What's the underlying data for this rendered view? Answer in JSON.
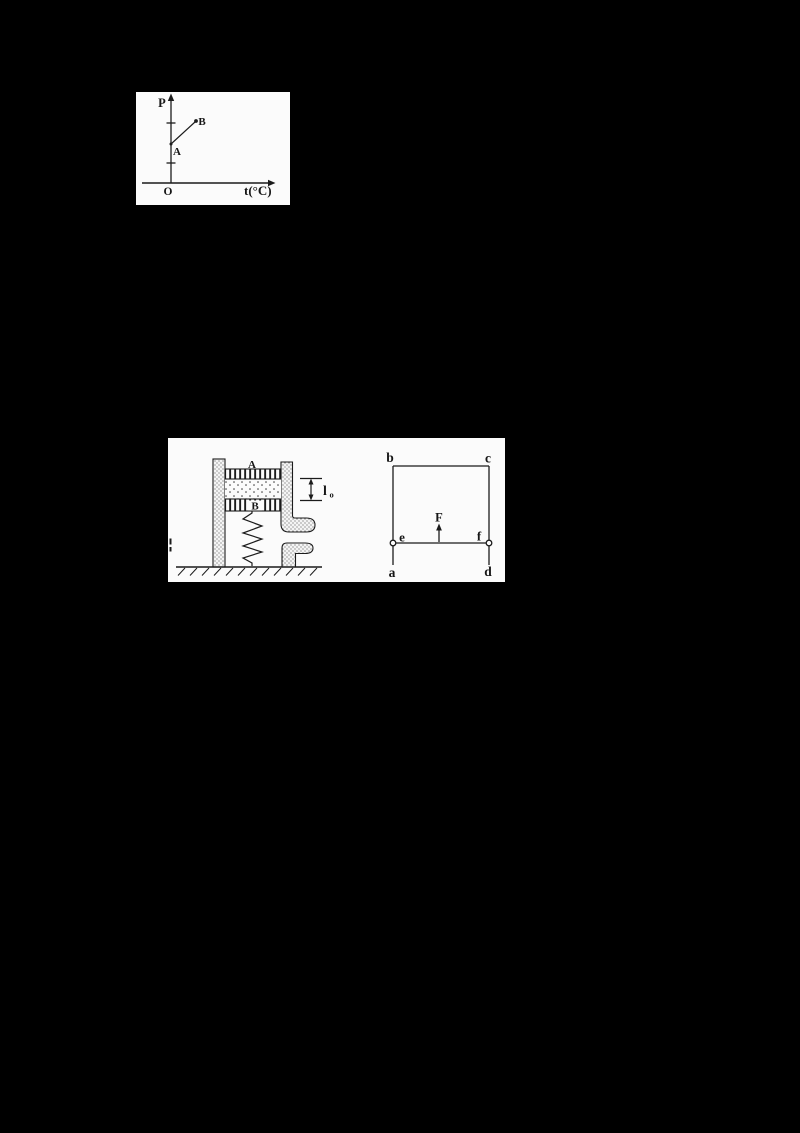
{
  "colors": {
    "page_bg": "#000000",
    "figure_bg": "#fbfbfb",
    "ink": "#1b1b1b"
  },
  "chart_data": {
    "type": "line",
    "title": "",
    "xlabel": "t(°C)",
    "ylabel": "P",
    "origin": "O",
    "axis_numeric_labels": false,
    "y_axis_tick_fractions": [
      0.23,
      0.7
    ],
    "series": [
      {
        "name": "AB",
        "points": [
          {
            "label": "A",
            "x": 0.0,
            "y": 0.45,
            "note": "on P axis between the two ticks"
          },
          {
            "label": "B",
            "x": 0.25,
            "y": 0.72,
            "note": "dot at upper-tick height, segment rises from A to B"
          }
        ]
      }
    ],
    "grid": false,
    "legend": false
  },
  "figure1": {
    "y_axis_label": "P",
    "x_axis_label": "t(°C)",
    "origin_label": "O",
    "point_a_label": "A",
    "point_b_label": "B"
  },
  "figure2": {
    "left": {
      "piston_top_label": "A",
      "piston_bottom_label": "B",
      "gas_gap_label_main": "l",
      "gas_gap_label_sub": "o"
    },
    "right": {
      "corner_top_left": "b",
      "corner_top_right": "c",
      "corner_bottom_left": "a",
      "corner_bottom_right": "d",
      "point_left": "e",
      "point_right": "f",
      "force_label": "F"
    }
  }
}
